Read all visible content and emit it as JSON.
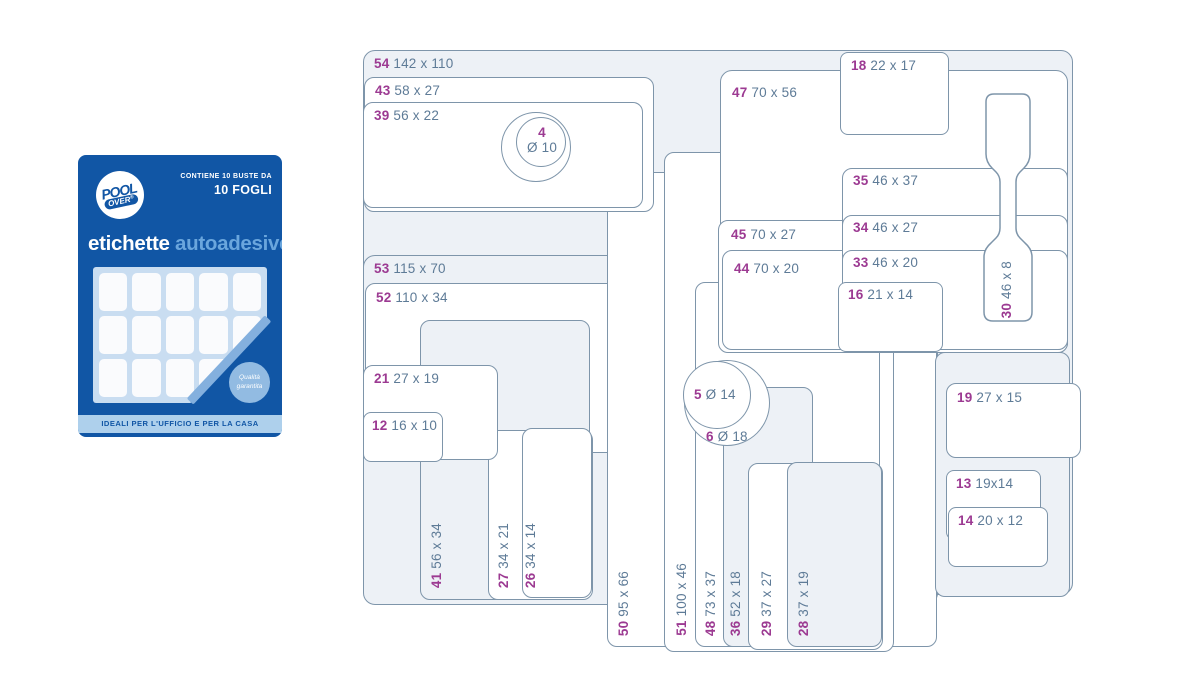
{
  "package": {
    "brand_top": "POOL",
    "brand_bottom": "OVER",
    "brand_reg": "®",
    "contains_line1": "CONTIENE 10 BUSTE DA",
    "contains_line2": "10 FOGLI",
    "title_primary": "etichette",
    "title_secondary": "autoadesive",
    "badge_line1": "Qualità",
    "badge_line2": "garantita",
    "footer": "IDEALI PER L'UFFICIO E PER LA CASA",
    "colors": {
      "blue": "#1156a5",
      "title_secondary": "#6aa6dd",
      "sheet": "#c9ddf1",
      "cell": "#fafbfd",
      "fold": "#84b0de",
      "badge": "#92bbe2",
      "footer_bar": "#aed0ec"
    }
  },
  "diagram": {
    "colors": {
      "stroke": "#7e95aa",
      "tint": "#edf1f6",
      "white": "#ffffff",
      "number": "#9c3a92",
      "dims": "#5e7b97"
    },
    "shapes": [
      {
        "name": "label-54",
        "type": "rect",
        "x": 363,
        "y": 50,
        "w": 710,
        "h": 545,
        "rad": 12,
        "fill": "tint",
        "label": {
          "num": "54",
          "dims": "142 x 110",
          "mode": "h",
          "x": 374,
          "y": 57
        }
      },
      {
        "name": "label-53",
        "type": "rect",
        "x": 363,
        "y": 255,
        "w": 575,
        "h": 350,
        "rad": 12,
        "fill": "tint",
        "label": {
          "num": "53",
          "dims": "115 x 70",
          "mode": "h",
          "x": 374,
          "y": 262
        }
      },
      {
        "name": "label-52",
        "type": "rect",
        "x": 365,
        "y": 283,
        "w": 550,
        "h": 170,
        "rad": 10,
        "fill": "white",
        "label": {
          "num": "52",
          "dims": "110 x 34",
          "mode": "h",
          "x": 376,
          "y": 291
        }
      },
      {
        "name": "label-50",
        "type": "rect",
        "x": 607,
        "y": 172,
        "w": 330,
        "h": 475,
        "rad": 10,
        "fill": "white",
        "label": {
          "num": "50",
          "dims": "95 x 66",
          "mode": "v",
          "x": 617,
          "y": 636
        }
      },
      {
        "name": "label-51",
        "type": "rect",
        "x": 664,
        "y": 152,
        "w": 230,
        "h": 500,
        "rad": 10,
        "fill": "white",
        "label": {
          "num": "51",
          "dims": "100 x 46",
          "mode": "v",
          "x": 675,
          "y": 636
        }
      },
      {
        "name": "label-48",
        "type": "rect",
        "x": 695,
        "y": 282,
        "w": 185,
        "h": 365,
        "rad": 10,
        "fill": "white",
        "label": {
          "num": "48",
          "dims": "73 x 37",
          "mode": "v",
          "x": 704,
          "y": 636
        }
      },
      {
        "name": "label-47",
        "type": "rect",
        "x": 720,
        "y": 70,
        "w": 348,
        "h": 280,
        "rad": 12,
        "fill": "white",
        "label": {
          "num": "47",
          "dims": "70 x 56",
          "mode": "h",
          "x": 732,
          "y": 86
        }
      },
      {
        "name": "label-45",
        "type": "rect",
        "x": 718,
        "y": 220,
        "w": 350,
        "h": 133,
        "rad": 10,
        "fill": "white",
        "label": {
          "num": "45",
          "dims": "70 x 27",
          "mode": "h",
          "x": 731,
          "y": 228
        }
      },
      {
        "name": "label-44",
        "type": "rect",
        "x": 722,
        "y": 250,
        "w": 346,
        "h": 100,
        "rad": 10,
        "fill": "white",
        "label": {
          "num": "44",
          "dims": "70 x 20",
          "mode": "h",
          "x": 734,
          "y": 262
        }
      },
      {
        "name": "label-43",
        "type": "rect",
        "x": 364,
        "y": 77,
        "w": 290,
        "h": 135,
        "rad": 10,
        "fill": "white",
        "label": {
          "num": "43",
          "dims": "58 x 27",
          "mode": "h",
          "x": 375,
          "y": 84
        }
      },
      {
        "name": "label-39",
        "type": "rect",
        "x": 363,
        "y": 102,
        "w": 280,
        "h": 106,
        "rad": 10,
        "fill": "white",
        "label": {
          "num": "39",
          "dims": "56 x 22",
          "mode": "h",
          "x": 374,
          "y": 109
        }
      },
      {
        "name": "circle-outer",
        "type": "circle",
        "x": 501,
        "y": 112,
        "w": 70,
        "h": 70,
        "fill": "white",
        "label": null
      },
      {
        "name": "label-4",
        "type": "circle",
        "x": 516,
        "y": 117,
        "w": 50,
        "h": 50,
        "fill": "white",
        "label": {
          "num": "4",
          "dims": "Ø 10",
          "mode": "c2",
          "x": 542,
          "y": 126
        }
      },
      {
        "name": "label-35",
        "type": "rect",
        "x": 842,
        "y": 168,
        "w": 226,
        "h": 185,
        "rad": 10,
        "fill": "white",
        "label": {
          "num": "35",
          "dims": "46 x 37",
          "mode": "h",
          "x": 853,
          "y": 174
        }
      },
      {
        "name": "label-34",
        "type": "rect",
        "x": 842,
        "y": 215,
        "w": 226,
        "h": 135,
        "rad": 10,
        "fill": "white",
        "label": {
          "num": "34",
          "dims": "46 x 27",
          "mode": "h",
          "x": 853,
          "y": 221
        }
      },
      {
        "name": "label-33",
        "type": "rect",
        "x": 842,
        "y": 250,
        "w": 226,
        "h": 100,
        "rad": 10,
        "fill": "white",
        "label": {
          "num": "33",
          "dims": "46 x 20",
          "mode": "h",
          "x": 853,
          "y": 256
        }
      },
      {
        "name": "label-16",
        "type": "rect",
        "x": 838,
        "y": 282,
        "w": 105,
        "h": 70,
        "rad": 8,
        "fill": "white",
        "label": {
          "num": "16",
          "dims": "21 x 14",
          "mode": "h",
          "x": 848,
          "y": 288
        }
      },
      {
        "name": "label-18",
        "type": "rect",
        "x": 840,
        "y": 52,
        "w": 109,
        "h": 83,
        "rad": 8,
        "fill": "white",
        "label": {
          "num": "18",
          "dims": "22 x 17",
          "mode": "h",
          "x": 851,
          "y": 59
        }
      },
      {
        "name": "label-30",
        "type": "tag",
        "label": {
          "num": "30",
          "dims": "46 x 8",
          "mode": "v",
          "x": 1000,
          "y": 318
        }
      },
      {
        "name": "label-36",
        "type": "rect",
        "x": 723,
        "y": 387,
        "w": 90,
        "h": 260,
        "rad": 10,
        "fill": "tint",
        "label": {
          "num": "36",
          "dims": "52 x 18",
          "mode": "v",
          "x": 729,
          "y": 636
        }
      },
      {
        "name": "label-29",
        "type": "rect",
        "x": 748,
        "y": 463,
        "w": 135,
        "h": 187,
        "rad": 10,
        "fill": "white",
        "label": {
          "num": "29",
          "dims": "37 x 27",
          "mode": "v",
          "x": 760,
          "y": 636
        }
      },
      {
        "name": "label-28",
        "type": "rect",
        "x": 787,
        "y": 462,
        "w": 95,
        "h": 185,
        "rad": 10,
        "fill": "tint",
        "label": {
          "num": "28",
          "dims": "37 x 19",
          "mode": "v",
          "x": 797,
          "y": 636
        }
      },
      {
        "name": "background-rect",
        "type": "rect",
        "x": 935,
        "y": 352,
        "w": 135,
        "h": 245,
        "rad": 10,
        "fill": "tint",
        "label": null
      },
      {
        "name": "label-19",
        "type": "rect",
        "x": 946,
        "y": 383,
        "w": 135,
        "h": 75,
        "rad": 10,
        "fill": "white",
        "label": {
          "num": "19",
          "dims": "27 x 15",
          "mode": "h",
          "x": 957,
          "y": 391
        }
      },
      {
        "name": "label-13",
        "type": "rect",
        "x": 946,
        "y": 470,
        "w": 95,
        "h": 70,
        "rad": 8,
        "fill": "white",
        "label": {
          "num": "13",
          "dims": "19x14",
          "mode": "h",
          "x": 956,
          "y": 477
        }
      },
      {
        "name": "label-14",
        "type": "rect",
        "x": 948,
        "y": 507,
        "w": 100,
        "h": 60,
        "rad": 8,
        "fill": "white",
        "label": {
          "num": "14",
          "dims": "20 x 12",
          "mode": "h",
          "x": 958,
          "y": 514
        }
      },
      {
        "name": "label-41",
        "type": "rect",
        "x": 420,
        "y": 320,
        "w": 170,
        "h": 280,
        "rad": 10,
        "fill": "tint",
        "label": {
          "num": "41",
          "dims": "56 x 34",
          "mode": "v",
          "x": 430,
          "y": 588
        }
      },
      {
        "name": "label-27",
        "type": "rect",
        "x": 488,
        "y": 430,
        "w": 105,
        "h": 170,
        "rad": 10,
        "fill": "white",
        "label": {
          "num": "27",
          "dims": "34 x 21",
          "mode": "v",
          "x": 497,
          "y": 588
        }
      },
      {
        "name": "label-26",
        "type": "rect",
        "x": 522,
        "y": 428,
        "w": 70,
        "h": 170,
        "rad": 10,
        "fill": "white",
        "label": {
          "num": "26",
          "dims": "34 x 14",
          "mode": "v",
          "x": 524,
          "y": 588
        }
      },
      {
        "name": "circle-6",
        "type": "circle",
        "x": 684,
        "y": 360,
        "w": 86,
        "h": 86,
        "fill": "white",
        "label": {
          "num": "6",
          "dims": "Ø 18",
          "mode": "h",
          "x": 706,
          "y": 430
        }
      },
      {
        "name": "circle-5",
        "type": "circle",
        "x": 683,
        "y": 361,
        "w": 68,
        "h": 68,
        "fill": "white",
        "label": {
          "num": "5",
          "dims": "Ø 14",
          "mode": "h",
          "x": 694,
          "y": 388
        }
      },
      {
        "name": "label-21",
        "type": "rect",
        "x": 363,
        "y": 365,
        "w": 135,
        "h": 95,
        "rad": 10,
        "fill": "white",
        "label": {
          "num": "21",
          "dims": "27 x 19",
          "mode": "h",
          "x": 374,
          "y": 372
        }
      },
      {
        "name": "label-12",
        "type": "rect",
        "x": 363,
        "y": 412,
        "w": 80,
        "h": 50,
        "rad": 8,
        "fill": "white",
        "label": {
          "num": "12",
          "dims": "16 x 10",
          "mode": "h",
          "x": 372,
          "y": 419
        }
      }
    ]
  }
}
